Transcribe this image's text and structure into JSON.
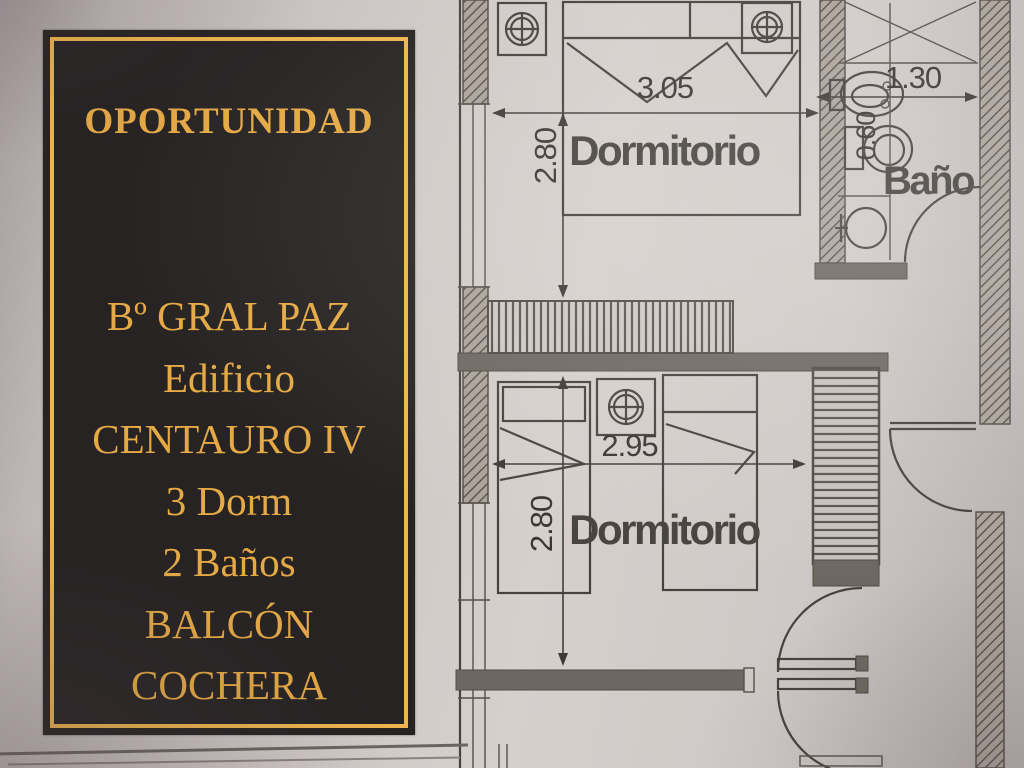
{
  "banner": {
    "title": "OPORTUNIDAD",
    "lines": [
      "Bº GRAL PAZ",
      "Edificio",
      "CENTAURO IV",
      "3 Dorm",
      "2 Baños",
      "BALCÓN",
      "COCHERA"
    ],
    "colors": {
      "background": "#272323",
      "border": "#eeb54e",
      "text": "#e5a945"
    }
  },
  "floorplan": {
    "ink_color": "#46423e",
    "labels": {
      "bedroom1": "Dormitorio",
      "bathroom": "Baño",
      "bedroom2": "Dormitorio"
    },
    "dimensions": {
      "bedroom1_width": "3.05",
      "bedroom1_depth": "2.80",
      "bathroom_width": "1.30",
      "bathroom_depth": "0.60",
      "bedroom2_width": "2.95",
      "bedroom2_depth": "2.80"
    },
    "icons": {
      "ceiling_light": "circled-cross ceiling light symbol",
      "count_ceiling_lights": 3
    }
  }
}
